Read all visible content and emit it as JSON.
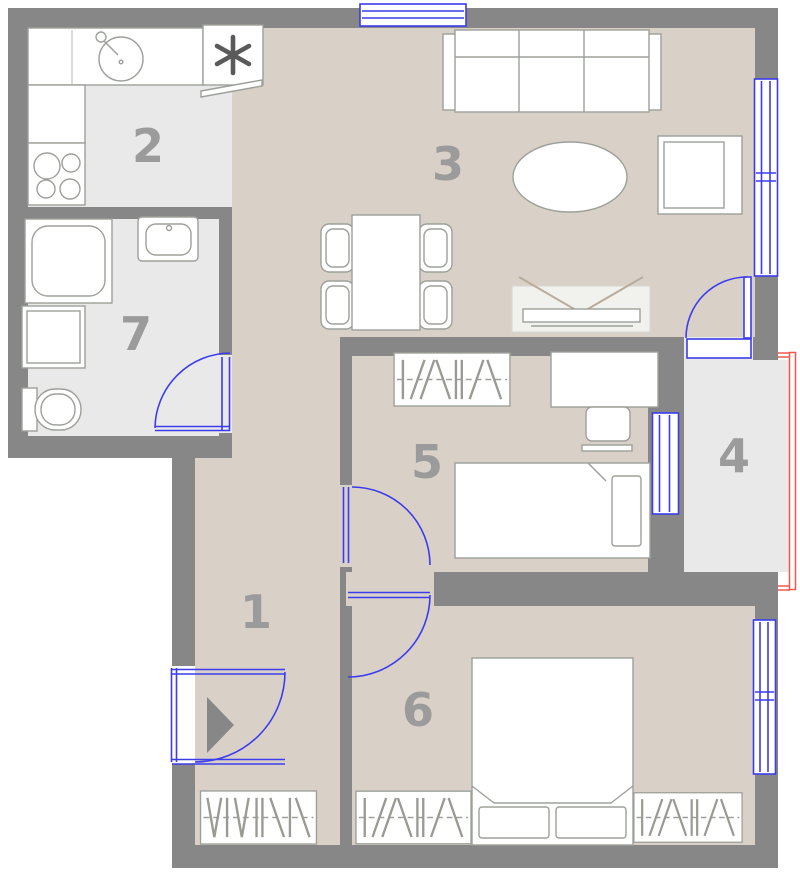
{
  "rooms": [
    {
      "number": "1"
    },
    {
      "number": "2"
    },
    {
      "number": "3"
    },
    {
      "number": "4"
    },
    {
      "number": "5"
    },
    {
      "number": "6"
    },
    {
      "number": "7"
    }
  ],
  "colors": {
    "wall": "#878787",
    "floor-main": "#d9d1c8",
    "floor-wet": "#e9e9e9",
    "blue": "#3c3cee",
    "red": "#f4574a",
    "num": "#9b9b9b",
    "fline": "#9da09a",
    "ffill": "#ffffff",
    "tvstand": "#f1f1ee",
    "bg": "#ffffff"
  },
  "furniture_icons": [
    "sofa-icon",
    "armchair-icon",
    "oval-coffee-table-icon",
    "tv-icon",
    "tv-stand-icon",
    "dining-table-icon",
    "dining-chair-icon",
    "kitchen-counter-icon",
    "kitchen-sink-icon",
    "stove-icon",
    "appliance-asterisk-icon",
    "shower-icon",
    "washing-machine-icon",
    "toilet-icon",
    "washbasin-icon",
    "wardrobe-rail-icon",
    "single-bed-icon",
    "desk-icon",
    "desk-chair-icon",
    "double-bed-icon",
    "pillow-icon",
    "entrance-arrow-icon",
    "door-swing-icon",
    "window-icon",
    "balcony-red-outline-icon"
  ]
}
